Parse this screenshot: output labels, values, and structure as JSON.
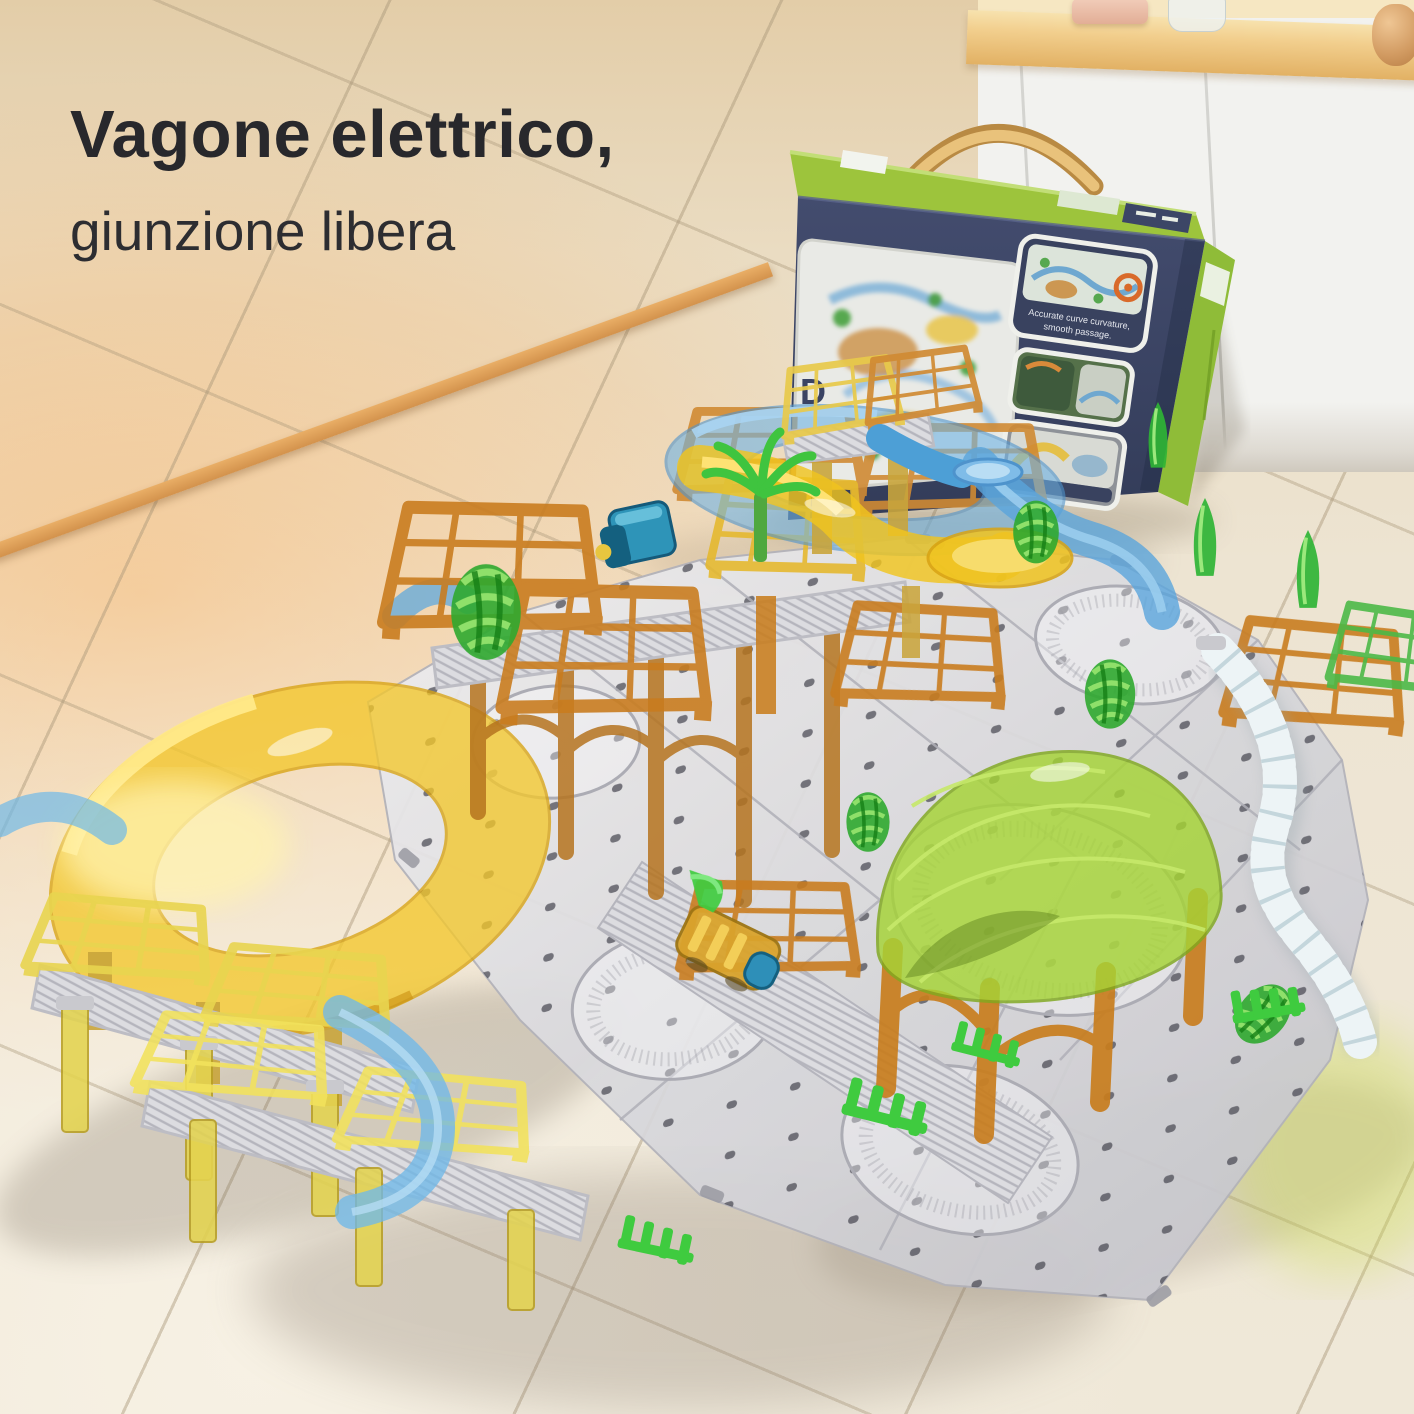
{
  "headline": {
    "line1": "Vagone elettrico,",
    "line2": "giunzione libera"
  },
  "box": {
    "front_letter": "D",
    "inset1_caption_line1": "Accurate curve curvature,",
    "inset1_caption_line2": "smooth passage."
  },
  "palette": {
    "wall_orange": "#EFB46E",
    "floor_cream": "#EDE4D2",
    "box_navy": "#3C4565",
    "box_lime": "#9DC43C",
    "handle_tan": "#E4B96E",
    "track_yellow": "#F3C72C",
    "track_blue": "#6FB3E4",
    "track_amber": "#C87D1E",
    "canopy_green": "#A5D335",
    "tree_green": "#2FB435",
    "plate_silver": "#D9D9DC",
    "chain_white": "#EDF4F6"
  }
}
